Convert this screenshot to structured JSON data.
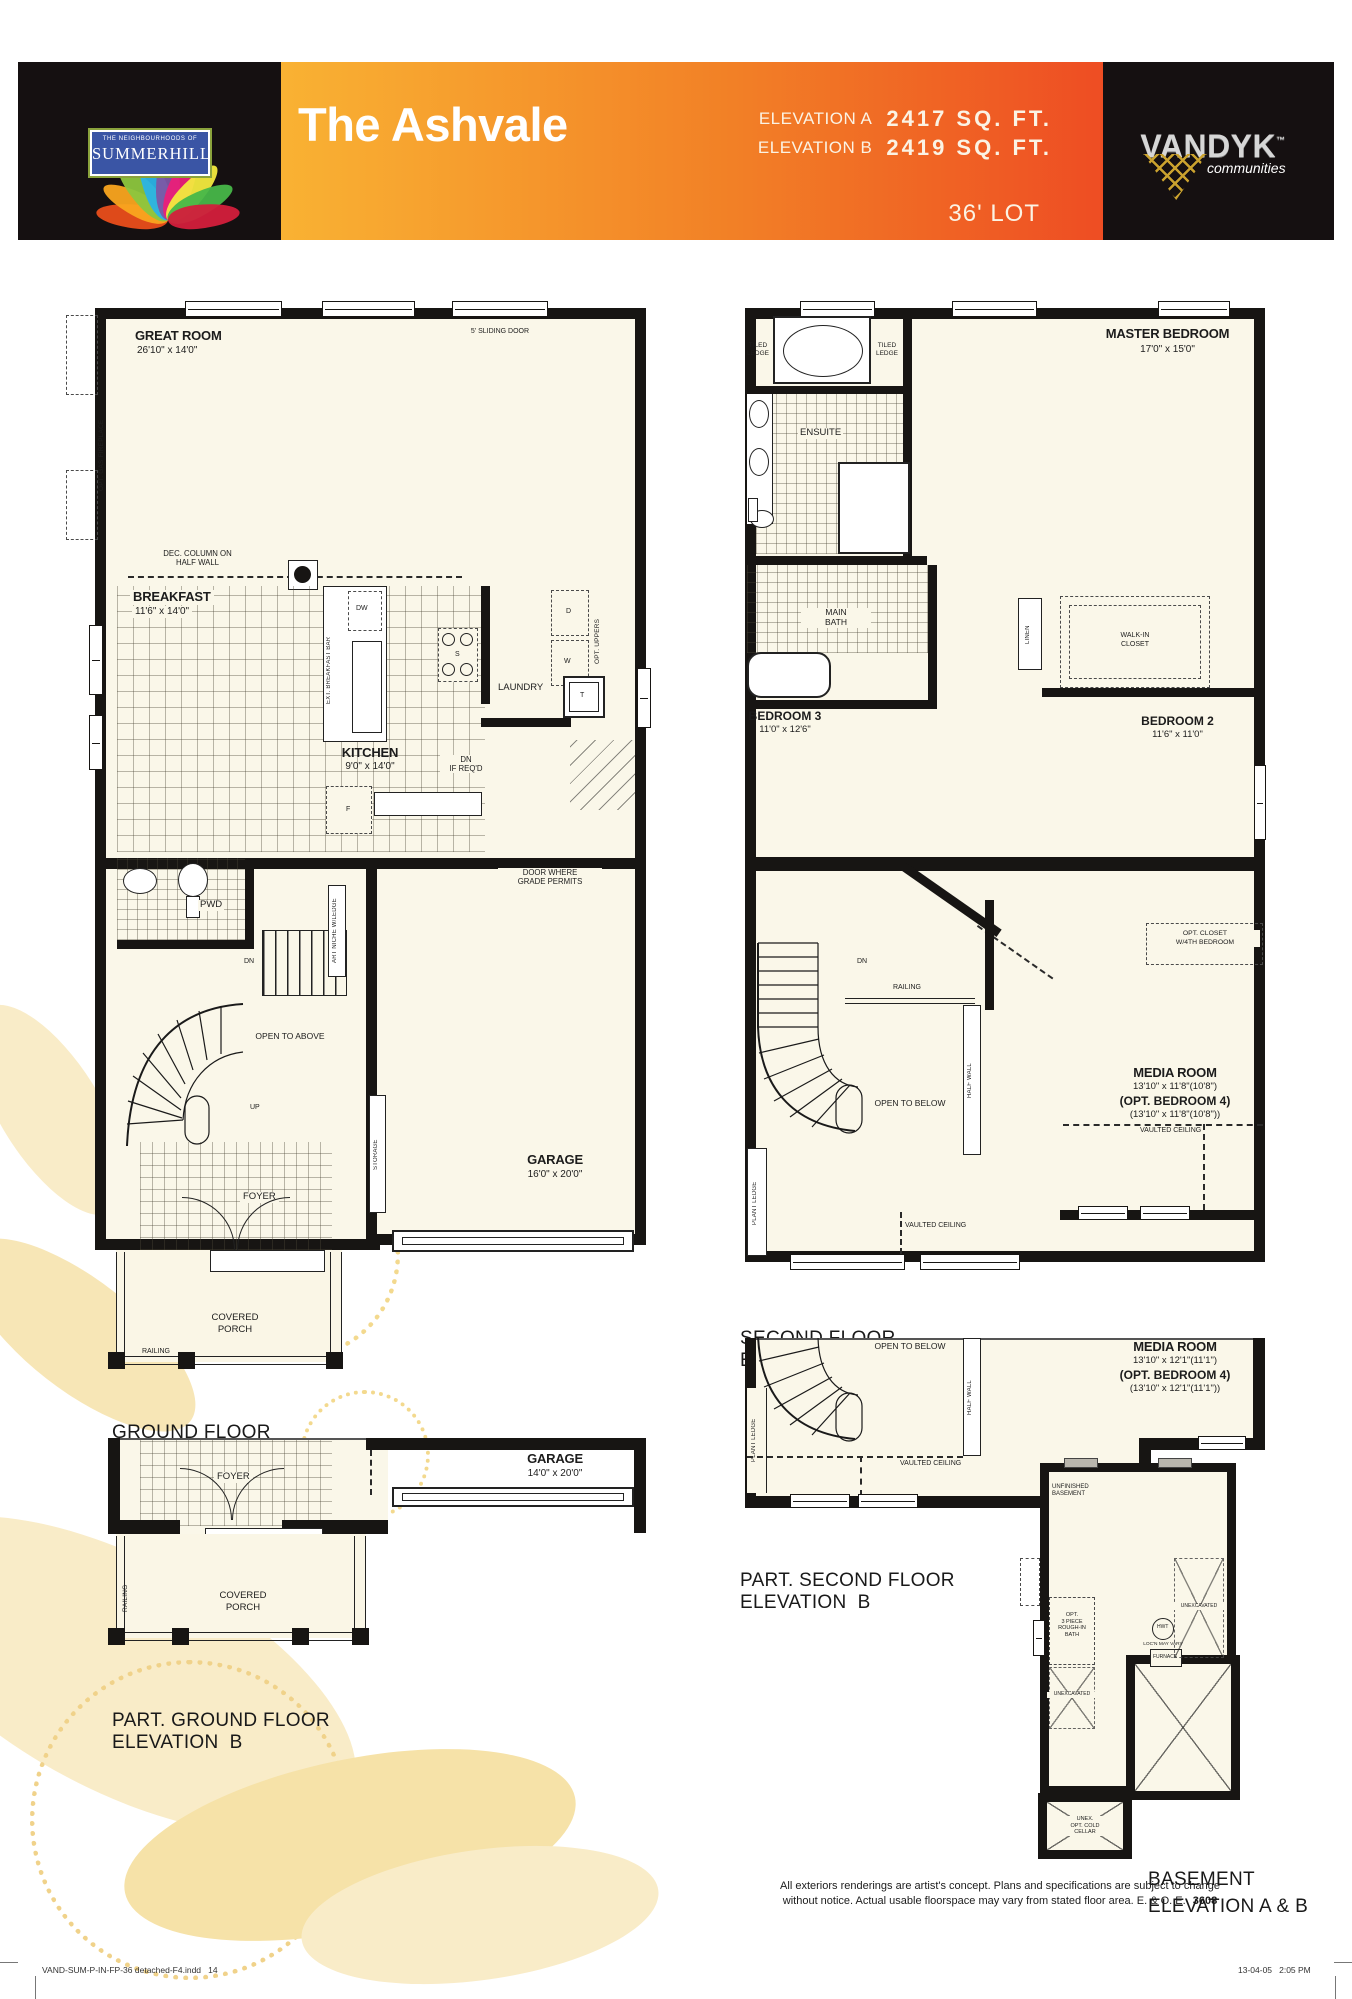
{
  "header": {
    "community_small": "THE NEIGHBOURHOODS OF",
    "community_name": "SUMMERHILL",
    "model_name": "The Ashvale",
    "elev_a_label": "ELEVATION A",
    "elev_a_value": "2417 SQ. FT.",
    "elev_b_label": "ELEVATION B",
    "elev_b_value": "2419 SQ. FT.",
    "lot": "36' LOT",
    "builder_name": "VANDYK",
    "builder_tm": "™",
    "builder_tagline": "communities",
    "colors": {
      "orange_left": "#f9b233",
      "orange_right": "#ee4d23",
      "panel_black": "#151011",
      "floor_cream": "#faf7e9",
      "wall_black": "#171513",
      "decor_yellow": "#f7e7b8"
    }
  },
  "ground_a": {
    "caption1": "GROUND FLOOR",
    "caption2": "ELEVATION A",
    "great_room_name": "GREAT ROOM",
    "great_room_dims": "26'10\" x 14'0\"",
    "sliding_door": "5' SLIDING DOOR",
    "opt_gas_fireplace": "OPT. GAS FIREPLACE",
    "dec_column1": "DEC. COLUMN ON",
    "dec_column2": "HALF WALL",
    "breakfast_name": "BREAKFAST",
    "breakfast_dims": "11'6\" x 14'0\"",
    "ext_breakfast_bar": "EXT. BREAKFAST BAR",
    "dw": "DW",
    "stove": "S",
    "fridge": "F",
    "dryer": "D",
    "washer": "W",
    "tub": "T",
    "opt_uppers": "OPT. UPPERS",
    "laundry": "LAUNDRY",
    "kitchen_name": "KITCHEN",
    "kitchen_dims": "9'0\" x 14'0\"",
    "dn_ifreqd1": "DN",
    "dn_ifreqd2": "IF REQ'D",
    "door_grade1": "DOOR WHERE",
    "door_grade2": "GRADE PERMITS",
    "pwd": "PWD",
    "dn": "DN",
    "art_niche": "ART NICHE W/LEDGE",
    "open_to_above": "OPEN TO ABOVE",
    "up": "UP",
    "storage": "STORAGE",
    "garage_name": "GARAGE",
    "garage_dims": "16'0\" x 20'0\"",
    "foyer": "FOYER",
    "porch1": "COVERED",
    "porch2": "PORCH",
    "railing": "RAILING"
  },
  "second_a": {
    "caption1": "SECOND FLOOR",
    "caption2": "ELEVATION A",
    "tiled1": "TILED",
    "tiled2": "LEDGE",
    "ensuite": "ENSUITE",
    "master_name": "MASTER BEDROOM",
    "master_dims": "17'0\" x 15'0\"",
    "main_bath1": "MAIN",
    "main_bath2": "BATH",
    "linen": "LINEN",
    "wic1": "WALK-IN",
    "wic2": "CLOSET",
    "bed3_name": "BEDROOM 3",
    "bed3_dims": "11'0\" x 12'6\"",
    "bed2_name": "BEDROOM 2",
    "bed2_dims": "11'6\" x 11'0\"",
    "dn": "DN",
    "railing": "RAILING",
    "half_wall": "HALF WALL",
    "open_to_below": "OPEN TO BELOW",
    "plant_ledge": "PLANT LEDGE",
    "opt_closet1": "OPT. CLOSET",
    "opt_closet2": "W/4TH BEDROOM",
    "media_name": "MEDIA ROOM",
    "media_dims": "13'10\" x 11'8\"(10'8\")",
    "media_opt": "(OPT. BEDROOM 4)",
    "media_opt_dims": "(13'10\" x 11'8\"(10'8\"))",
    "vaulted": "VAULTED CEILING"
  },
  "part_second_b": {
    "caption1": "PART. SECOND FLOOR",
    "caption2": "ELEVATION  B",
    "open_to_below": "OPEN TO BELOW",
    "half_wall": "HALF WALL",
    "plant_ledge": "PLANT LEDGE",
    "media_name": "MEDIA ROOM",
    "media_dims": "13'10\" x 12'1\"(11'1\")",
    "media_opt": "(OPT. BEDROOM 4)",
    "media_opt_dims": "(13'10\" x 12'1\"(11'1\"))",
    "vaulted": "VAULTED CEILING"
  },
  "part_ground_b": {
    "caption1": "PART. GROUND FLOOR",
    "caption2": "ELEVATION  B",
    "foyer": "FOYER",
    "garage_name": "GARAGE",
    "garage_dims": "14'0\" x 20'0\"",
    "porch1": "COVERED",
    "porch2": "PORCH",
    "railing": "RAILING"
  },
  "basement": {
    "caption1": "BASEMENT",
    "caption2": "ELEVATION A & B",
    "unfinished1": "UNFINISHED",
    "unfinished2": "BASEMENT",
    "opt_bath1": "OPT.",
    "opt_bath2": "3 PIECE",
    "opt_bath3": "ROUGH-IN",
    "opt_bath4": "BATH",
    "unexcavated": "UNEXCAVATED",
    "hwt": "HWT",
    "hwt_note": "LOC'N MAY VARY",
    "furnace": "FURNACE",
    "cold1": "UNEX.",
    "cold2": "OPT. COLD",
    "cold3": "CELLAR"
  },
  "footer": {
    "disclaimer1": "All exteriors renderings are artist's concept. Plans and specifications are subject to change",
    "disclaimer2": "without notice. Actual usable floorspace may vary from stated floor area. E. & O. E.",
    "code": "3608",
    "print_file": "VAND-SUM-P-IN-FP-36 detached-F4.indd   14",
    "print_time": "13-04-05   2:05 PM"
  }
}
